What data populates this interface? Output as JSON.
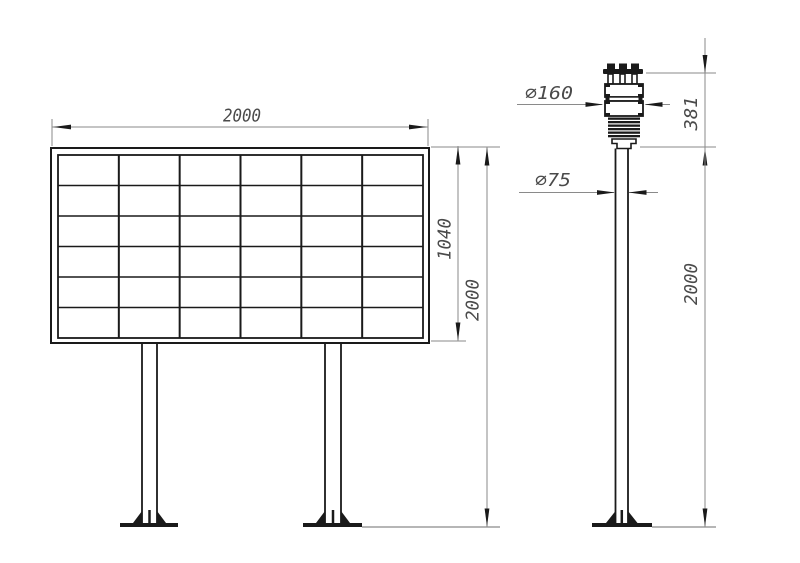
{
  "colors": {
    "background": "#ffffff",
    "object_line": "#1a1a1a",
    "dimension_line": "#8a8a8a",
    "dimension_text": "#4a4a4a"
  },
  "board_view": {
    "grid": {
      "columns": 6,
      "rows": 6
    },
    "dims": {
      "width": "2000",
      "panel_height": "1040",
      "overall_height": "2000"
    }
  },
  "sensor_view": {
    "dims": {
      "sensor_diameter": "∅160",
      "sensor_height": "381",
      "pole_diameter": "∅75",
      "pole_height": "2000"
    }
  }
}
